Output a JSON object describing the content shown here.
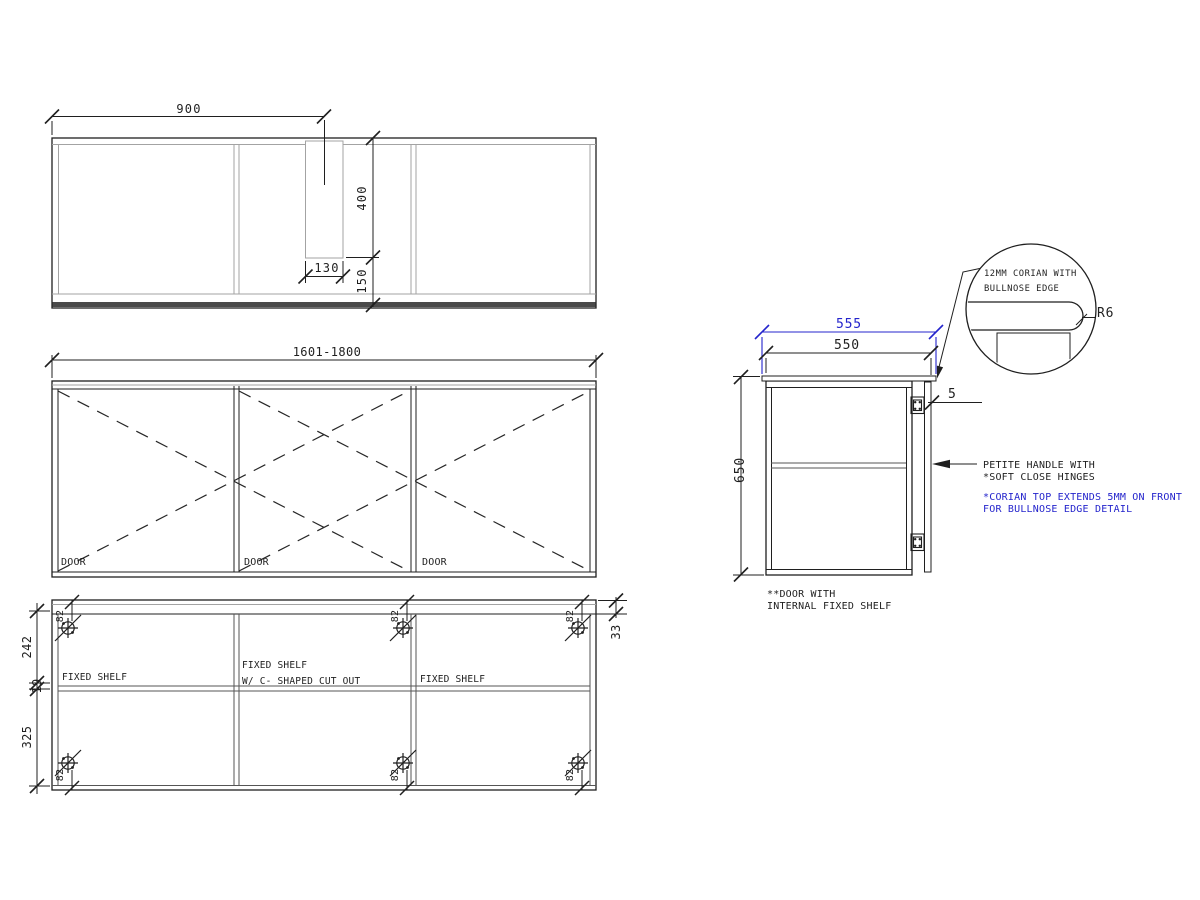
{
  "drawing": {
    "plan": {
      "dim_width": "900",
      "dim_depth": "400",
      "dim_slot_width": "130",
      "dim_slot_front": "150"
    },
    "elevation": {
      "dim_width_range": "1601-1800",
      "door_label": "DOOR"
    },
    "internal": {
      "dim_top_section": "242",
      "dim_shelf_thickness": "19",
      "dim_bottom_section": "325",
      "dim_top_rail": "33",
      "dim_hinge_offset": "82",
      "shelf_label": "FIXED SHELF",
      "shelf_cutout_label": "W/ C- SHAPED CUT OUT"
    },
    "side": {
      "dim_top_width": "555",
      "dim_carcass_depth": "550",
      "dim_height": "650",
      "dim_overhang": "5",
      "handle_note_line1": "PETITE HANDLE WITH",
      "handle_note_line2": "*SOFT CLOSE HINGES",
      "corian_note_line1": "*CORIAN TOP EXTENDS 5MM ON FRONT",
      "corian_note_line2": "FOR BULLNOSE EDGE DETAIL",
      "door_note_line1": "**DOOR WITH",
      "door_note_line2": "INTERNAL FIXED SHELF"
    },
    "detail": {
      "label_line1": "12MM CORIAN WITH",
      "label_line2": "BULLNOSE EDGE",
      "radius_label": "R6"
    },
    "colors": {
      "accent_blue": "#2424cc",
      "line_dark": "#1f1f1f",
      "line_grey": "#a3a3a3"
    }
  }
}
